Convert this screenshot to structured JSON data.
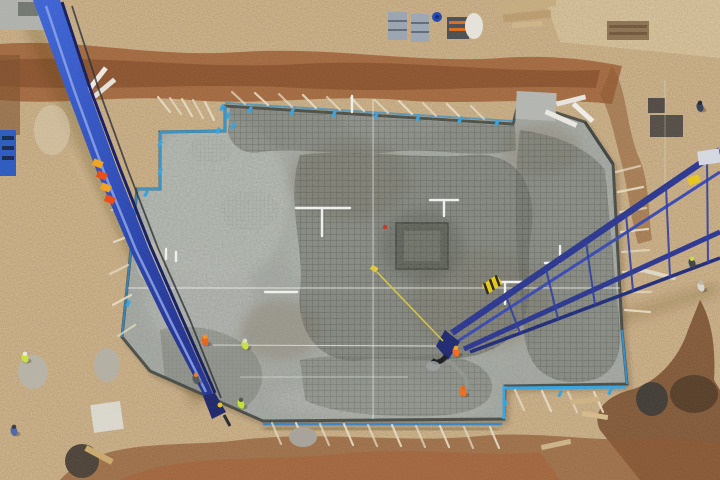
{
  "meta": {
    "title": "Aerial drone view - concrete foundation pour at construction site",
    "alt": "Top-down aerial photo of a large concrete foundation slab with rebar mesh, two blue concrete pump booms, workers in orange and yellow hi-vis, surrounded by excavated brown earth"
  },
  "palette": {
    "dirt": "#c3a478",
    "dirtLight": "#d3bd93",
    "trench": "#9a5c32",
    "trenchDark": "#6e4426",
    "trenchRed": "#a45a30",
    "slab": "#a6aba6",
    "slabLight": "#b8bdb8",
    "meshDark": "#42463f",
    "edgeBlue": "#2f8ccc",
    "edgeBlueBright": "#31a2e2",
    "boomBlue": "#2e51c4",
    "boomNavy": "#1d2f8e",
    "boom2Navy": "#28348f",
    "hazardOrange": "#e84912",
    "hazardYellow": "#f0a01e",
    "workerOrange": "#ee6418",
    "hiVisYellow": "#c9df3e",
    "pipeWhite": "#eef0ee",
    "stake": "#e6dcc4",
    "stringWhite": "#f2f2ee"
  },
  "scene": {
    "workers": [
      {
        "x": 205,
        "y": 341,
        "body": "#e8601c",
        "head": "#f59018"
      },
      {
        "x": 196,
        "y": 379,
        "body": "#50555a",
        "head": "#ef7a14"
      },
      {
        "x": 245,
        "y": 345,
        "body": "#c9df3e",
        "head": "#d8dcd8"
      },
      {
        "x": 241,
        "y": 404,
        "body": "#bfdf3a",
        "head": "#4a4f52"
      },
      {
        "x": 456,
        "y": 352,
        "body": "#ef6a16",
        "head": "#f5a021"
      },
      {
        "x": 463,
        "y": 392,
        "body": "#ef6a16",
        "head": "#e8610f"
      },
      {
        "x": 25,
        "y": 358,
        "body": "#c9df3e",
        "head": "#e8e8e4"
      },
      {
        "x": 14,
        "y": 431,
        "body": "#4a62a8",
        "head": "#303848"
      },
      {
        "x": 700,
        "y": 107,
        "body": "#323e58",
        "head": "#20262e"
      },
      {
        "x": 692,
        "y": 263,
        "body": "#3c4248",
        "head": "#c8dc40"
      },
      {
        "x": 701,
        "y": 287,
        "body": "#d8d4cc",
        "head": "#b8b4ac"
      }
    ],
    "stakes": [
      [
        245,
        104,
        232,
        92
      ],
      [
        268,
        105,
        255,
        93
      ],
      [
        292,
        107,
        279,
        94
      ],
      [
        316,
        108,
        303,
        95
      ],
      [
        340,
        110,
        327,
        97
      ],
      [
        364,
        111,
        351,
        98
      ],
      [
        388,
        113,
        375,
        100
      ],
      [
        412,
        114,
        399,
        101
      ],
      [
        436,
        116,
        423,
        103
      ],
      [
        460,
        117,
        447,
        104
      ],
      [
        484,
        119,
        471,
        106
      ],
      [
        170,
        112,
        158,
        97
      ],
      [
        181,
        114,
        170,
        98
      ],
      [
        192,
        116,
        182,
        99
      ],
      [
        203,
        118,
        193,
        100
      ],
      [
        214,
        120,
        205,
        102
      ],
      [
        616,
        172,
        640,
        166
      ],
      [
        618,
        192,
        643,
        187
      ],
      [
        620,
        212,
        646,
        208
      ],
      [
        621,
        232,
        648,
        229
      ],
      [
        622,
        252,
        649,
        250
      ],
      [
        623,
        272,
        650,
        271
      ],
      [
        624,
        292,
        651,
        292
      ],
      [
        625,
        310,
        650,
        312
      ],
      [
        272,
        423,
        281,
        444
      ],
      [
        296,
        423,
        305,
        444
      ],
      [
        320,
        424,
        329,
        445
      ],
      [
        344,
        424,
        353,
        445
      ],
      [
        368,
        425,
        377,
        446
      ],
      [
        392,
        425,
        401,
        446
      ],
      [
        416,
        426,
        425,
        447
      ],
      [
        440,
        426,
        449,
        447
      ],
      [
        464,
        427,
        473,
        448
      ],
      [
        490,
        427,
        499,
        448
      ],
      [
        515,
        390,
        524,
        410
      ],
      [
        542,
        391,
        551,
        411
      ],
      [
        568,
        392,
        577,
        412
      ],
      [
        594,
        392,
        603,
        412
      ],
      [
        130,
        205,
        112,
        210
      ],
      [
        132,
        235,
        114,
        242
      ],
      [
        128,
        265,
        110,
        274
      ],
      [
        131,
        295,
        113,
        305
      ],
      [
        135,
        325,
        118,
        336
      ]
    ],
    "pipes": {
      "h": [
        [
          296,
          208,
          54
        ],
        [
          265,
          292,
          32
        ],
        [
          489,
          282,
          40
        ],
        [
          430,
          200,
          28
        ],
        [
          545,
          263,
          14
        ]
      ],
      "v": [
        [
          322,
          208,
          28
        ],
        [
          505,
          282,
          22
        ],
        [
          444,
          200,
          16
        ],
        [
          352,
          96,
          16
        ],
        [
          166,
          249,
          10
        ],
        [
          176,
          252,
          9
        ],
        [
          560,
          246,
          10
        ]
      ]
    },
    "strings": [
      [
        373,
        99,
        373,
        419,
        0.8
      ],
      [
        128,
        288,
        620,
        288,
        0.8
      ],
      [
        213,
        345,
        438,
        346,
        0.75
      ],
      [
        240,
        377,
        408,
        377,
        0.5
      ],
      [
        665,
        80,
        665,
        195,
        0.35
      ]
    ],
    "rope": [
      377,
      272,
      443,
      341
    ],
    "clamps": [
      [
        222,
        104
      ],
      [
        228,
        112
      ],
      [
        233,
        122
      ],
      [
        218,
        127
      ],
      [
        250,
        106
      ],
      [
        292,
        108
      ],
      [
        334,
        110
      ],
      [
        376,
        112
      ],
      [
        418,
        114
      ],
      [
        460,
        116
      ],
      [
        497,
        119
      ],
      [
        518,
        103
      ],
      [
        160,
        140
      ],
      [
        160,
        168
      ],
      [
        146,
        190
      ],
      [
        128,
        300
      ],
      [
        505,
        400
      ],
      [
        560,
        390
      ],
      [
        610,
        388
      ]
    ],
    "boom2_rungs": [
      [
        506,
        296,
        520,
        333
      ],
      [
        546,
        269,
        558,
        319
      ],
      [
        586,
        242,
        595,
        305
      ],
      [
        626,
        214,
        633,
        291
      ],
      [
        666,
        187,
        670,
        277
      ],
      [
        707,
        159,
        708,
        263
      ]
    ],
    "objects": [
      {
        "t": "rect",
        "x": 0,
        "y": 0,
        "w": 44,
        "h": 30,
        "fill": "#aeb0ac"
      },
      {
        "t": "rect",
        "x": 18,
        "y": 2,
        "w": 20,
        "h": 14,
        "fill": "#70756f"
      },
      {
        "t": "rect",
        "x": 0,
        "y": 130,
        "w": 16,
        "h": 46,
        "fill": "#2a58c0"
      },
      {
        "t": "rect",
        "x": 2,
        "y": 136,
        "w": 12,
        "h": 4,
        "fill": "#14264f"
      },
      {
        "t": "rect",
        "x": 2,
        "y": 146,
        "w": 12,
        "h": 4,
        "fill": "#14264f"
      },
      {
        "t": "rect",
        "x": 2,
        "y": 156,
        "w": 12,
        "h": 4,
        "fill": "#14264f"
      },
      {
        "t": "rect",
        "x": 388,
        "y": 12,
        "w": 19,
        "h": 28,
        "fill": "#98a3b0"
      },
      {
        "t": "rect",
        "x": 388,
        "y": 20,
        "w": 19,
        "h": 2,
        "fill": "#5f6874"
      },
      {
        "t": "rect",
        "x": 388,
        "y": 29,
        "w": 19,
        "h": 2,
        "fill": "#5f6874"
      },
      {
        "t": "rect",
        "x": 411,
        "y": 14,
        "w": 18,
        "h": 28,
        "fill": "#9aa5b2"
      },
      {
        "t": "rect",
        "x": 411,
        "y": 22,
        "w": 18,
        "h": 2,
        "fill": "#5f6874"
      },
      {
        "t": "rect",
        "x": 411,
        "y": 31,
        "w": 18,
        "h": 2,
        "fill": "#5f6874"
      },
      {
        "t": "circle",
        "cx": 437,
        "cy": 17,
        "r": 5,
        "fill": "#1e46ae"
      },
      {
        "t": "circle",
        "cx": 437,
        "cy": 17,
        "r": 2,
        "fill": "#0e2a70"
      },
      {
        "t": "rect",
        "x": 447,
        "y": 17,
        "w": 22,
        "h": 22,
        "fill": "#474c52"
      },
      {
        "t": "rect",
        "x": 449,
        "y": 21,
        "w": 18,
        "h": 3,
        "fill": "#d86a1e"
      },
      {
        "t": "rect",
        "x": 449,
        "y": 28,
        "w": 18,
        "h": 3,
        "fill": "#d86a1e"
      },
      {
        "t": "ellipse",
        "cx": 474,
        "cy": 26,
        "rx": 9,
        "ry": 13,
        "fill": "#e4e2da"
      },
      {
        "t": "rect",
        "x": 498,
        "y": 0,
        "w": 58,
        "h": 10,
        "fill": "#c4aa7e",
        "rot": -8
      },
      {
        "t": "rect",
        "x": 503,
        "y": 12,
        "w": 48,
        "h": 8,
        "fill": "#b89a6c",
        "rot": -6
      },
      {
        "t": "rect",
        "x": 512,
        "y": 22,
        "w": 30,
        "h": 5,
        "fill": "#cdb488",
        "rot": -4
      },
      {
        "t": "rect",
        "x": 607,
        "y": 21,
        "w": 42,
        "h": 19,
        "fill": "#8a7050"
      },
      {
        "t": "rect",
        "x": 609,
        "y": 25,
        "w": 38,
        "h": 3,
        "fill": "#6e563c"
      },
      {
        "t": "rect",
        "x": 609,
        "y": 32,
        "w": 38,
        "h": 3,
        "fill": "#6e563c"
      },
      {
        "t": "rect",
        "x": 648,
        "y": 98,
        "w": 17,
        "h": 15,
        "fill": "#4e4842"
      },
      {
        "t": "rect",
        "x": 650,
        "y": 115,
        "w": 33,
        "h": 22,
        "fill": "#514b44"
      },
      {
        "t": "ellipse",
        "cx": 33,
        "cy": 372,
        "rx": 15,
        "ry": 17,
        "fill": "#b5b1a4"
      },
      {
        "t": "ellipse",
        "cx": 107,
        "cy": 365,
        "rx": 13,
        "ry": 17,
        "fill": "#b2aea2"
      },
      {
        "t": "rect",
        "x": 92,
        "y": 403,
        "w": 30,
        "h": 28,
        "fill": "#d9d6cd",
        "rot": -8
      },
      {
        "t": "ellipse",
        "cx": 82,
        "cy": 461,
        "rx": 17,
        "ry": 17,
        "fill": "#4a4036"
      },
      {
        "t": "rect",
        "x": 84,
        "y": 452,
        "w": 30,
        "h": 6,
        "fill": "#c8a86c",
        "rot": 28
      },
      {
        "t": "ellipse",
        "cx": 303,
        "cy": 437,
        "rx": 14,
        "ry": 10,
        "fill": "#a5a199"
      },
      {
        "t": "rect",
        "x": 516,
        "y": 92,
        "w": 40,
        "h": 28,
        "fill": "#b2b4b0",
        "rot": 3
      },
      {
        "t": "rect",
        "x": 544,
        "y": 116,
        "w": 34,
        "h": 5,
        "fill": "#e9e7e1",
        "rot": 24
      },
      {
        "t": "rect",
        "x": 556,
        "y": 98,
        "w": 30,
        "h": 5,
        "fill": "#e6e4de",
        "rot": -14
      },
      {
        "t": "rect",
        "x": 570,
        "y": 110,
        "w": 26,
        "h": 5,
        "fill": "#efede8",
        "rot": 42
      },
      {
        "t": "rect",
        "x": 571,
        "y": 398,
        "w": 28,
        "h": 5,
        "fill": "#cdb183",
        "rot": -6
      },
      {
        "t": "rect",
        "x": 582,
        "y": 413,
        "w": 26,
        "h": 5,
        "fill": "#d4b98b",
        "rot": 9
      },
      {
        "t": "rect",
        "x": 541,
        "y": 442,
        "w": 30,
        "h": 5,
        "fill": "#cbb287",
        "rot": -12
      },
      {
        "t": "rect",
        "x": 640,
        "y": 272,
        "w": 36,
        "h": 4,
        "fill": "#ddd6c6",
        "rot": 14
      },
      {
        "t": "ellipse",
        "cx": 652,
        "cy": 399,
        "rx": 16,
        "ry": 17,
        "fill": "#3f3a34"
      },
      {
        "t": "ellipse",
        "cx": 694,
        "cy": 394,
        "rx": 24,
        "ry": 19,
        "fill": "#553c26"
      },
      {
        "t": "rect",
        "x": 80,
        "y": 78,
        "w": 32,
        "h": 5,
        "fill": "#eceae4",
        "rot": -52
      },
      {
        "t": "rect",
        "x": 90,
        "y": 86,
        "w": 28,
        "h": 5,
        "fill": "#e4e0d6",
        "rot": -40
      },
      {
        "t": "ellipse",
        "cx": 52,
        "cy": 130,
        "rx": 18,
        "ry": 25,
        "fill": "#d8cdb2",
        "op": 0.5
      },
      {
        "t": "ellipse",
        "cx": 150,
        "cy": 262,
        "rx": 14,
        "ry": 20,
        "fill": "#d8cdb2",
        "op": 0.35
      }
    ]
  }
}
